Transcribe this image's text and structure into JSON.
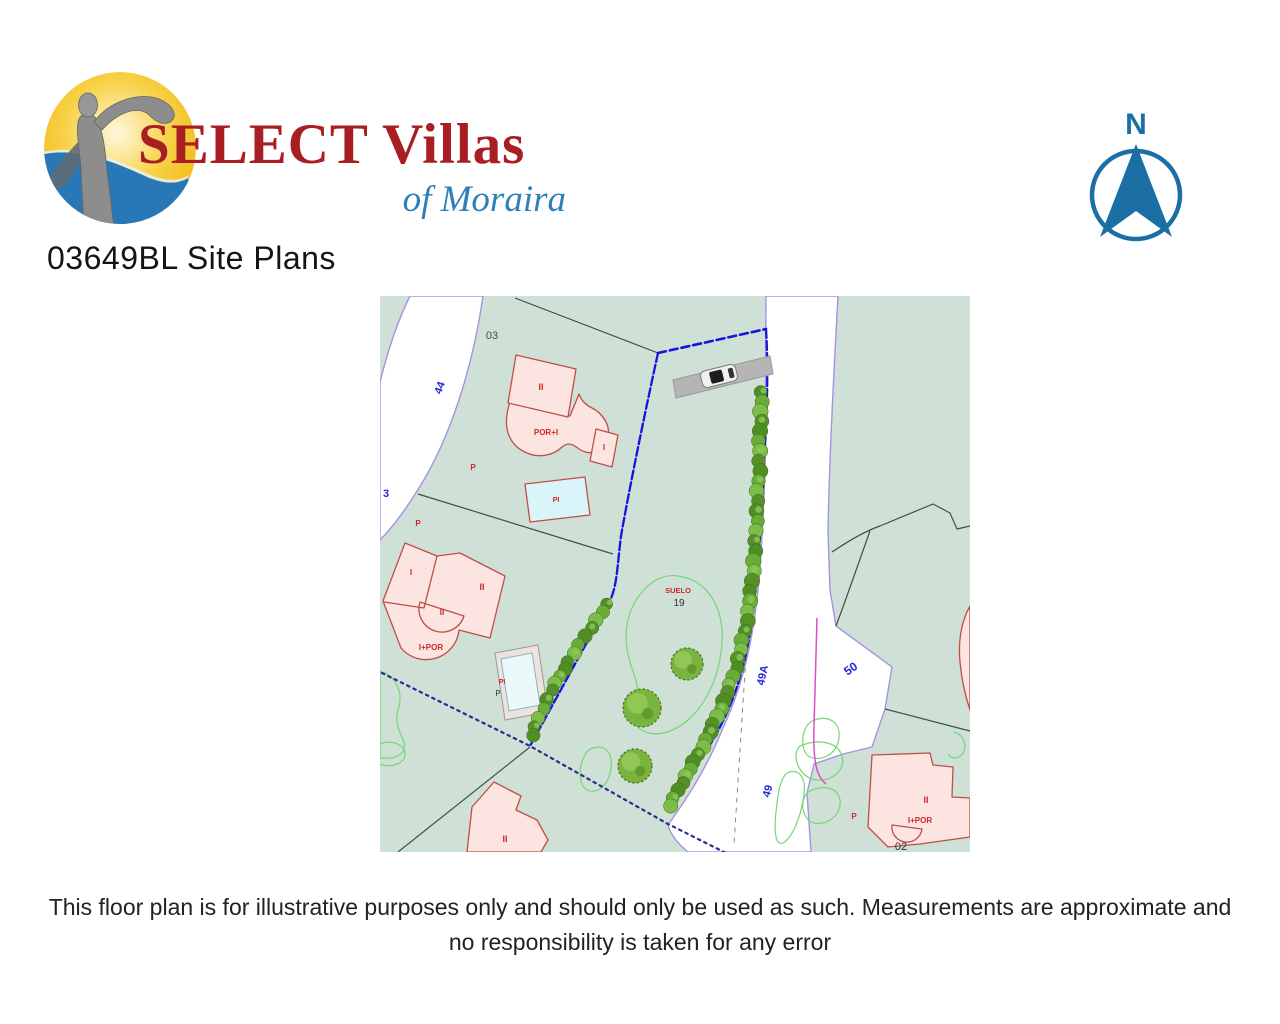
{
  "page": {
    "title": "03649BL Site Plans",
    "disclaimer": "This floor plan is for illustrative purposes only and should only be used as such. Measurements are approximate and no responsibility is taken for any error"
  },
  "logo": {
    "brand": "SELECT Villas",
    "tagline": "of Moraira",
    "colors": {
      "brand_red": "#a91e23",
      "tagline_blue": "#2e80ba",
      "sun_yellow": "#f0bb17",
      "sea_blue": "#2878b8",
      "statue_grey": "#8d8d8d"
    }
  },
  "compass": {
    "north_label": "N",
    "color": "#1b6fa5"
  },
  "site_plan": {
    "colors": {
      "parcel_green": "#cfe0d7",
      "road_white": "#ffffff",
      "road_edge_purple": "#a493e0",
      "cadastral_blue": "#1515dd",
      "building_fill": "#fce4e0",
      "building_stroke": "#bf4f45",
      "pool_fill": "#d9f5f9",
      "hedge_green": "#64a833",
      "contour_green": "#74d874",
      "driveway_grey": "#b5b5b5",
      "magenta_line": "#d650c8"
    },
    "labels": {
      "plot03": "03",
      "plot19": "19",
      "plot50": "50",
      "plot02": "02",
      "road44": "44",
      "road3": "3",
      "road49a": "49A",
      "road49": "49",
      "suelo": "SUELO",
      "storeys_ii": "II",
      "storeys_i": "I",
      "por_i": "POR+I",
      "i_por": "I+POR",
      "pool_pi": "PI",
      "mark_p": "P"
    }
  }
}
